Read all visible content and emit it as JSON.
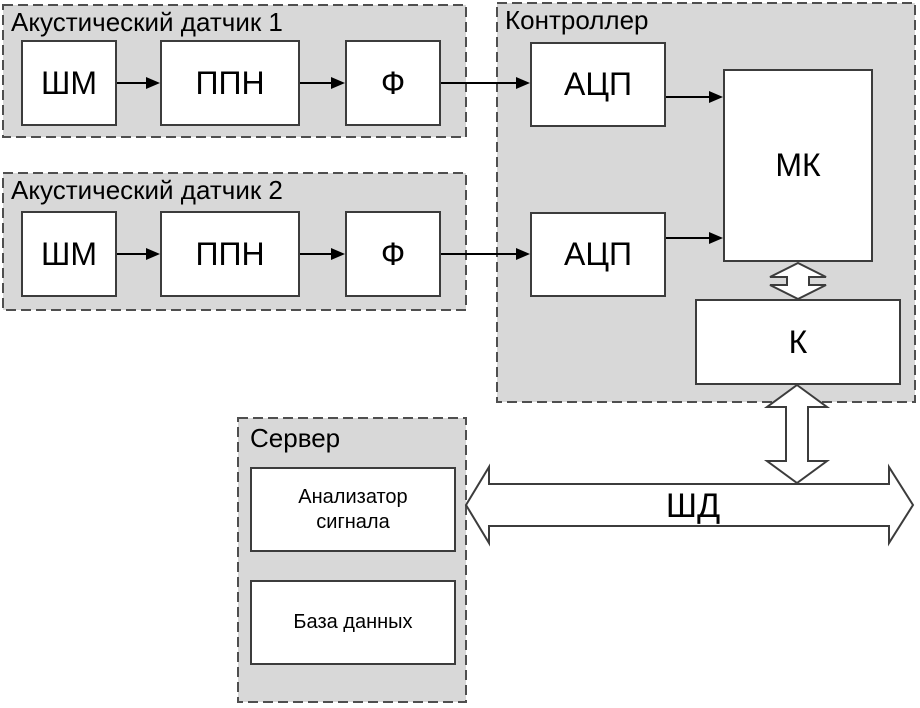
{
  "sensor1": {
    "label": "Акустический датчик 1",
    "blocks": {
      "shm": "ШМ",
      "ppn": "ППН",
      "filter": "Ф"
    }
  },
  "sensor2": {
    "label": "Акустический датчик 2",
    "blocks": {
      "shm": "ШМ",
      "ppn": "ППН",
      "filter": "Ф"
    }
  },
  "controller": {
    "label": "Контроллер",
    "blocks": {
      "adc1": "АЦП",
      "adc2": "АЦП",
      "mcu": "МК",
      "k": "К"
    }
  },
  "server": {
    "label": "Сервер",
    "blocks": {
      "analyzer": "Анализатор сигнала",
      "database": "База данных"
    }
  },
  "bus": {
    "label": "ШД"
  },
  "colors": {
    "container_fill": "#d8d8d8",
    "container_border": "#4f4f4f",
    "block_fill": "#ffffff",
    "block_border": "#3c3c3c",
    "arrow": "#000000",
    "hollow_arrow_stroke": "#3c3c3c",
    "hollow_arrow_fill": "#ffffff",
    "text": "#000000"
  }
}
